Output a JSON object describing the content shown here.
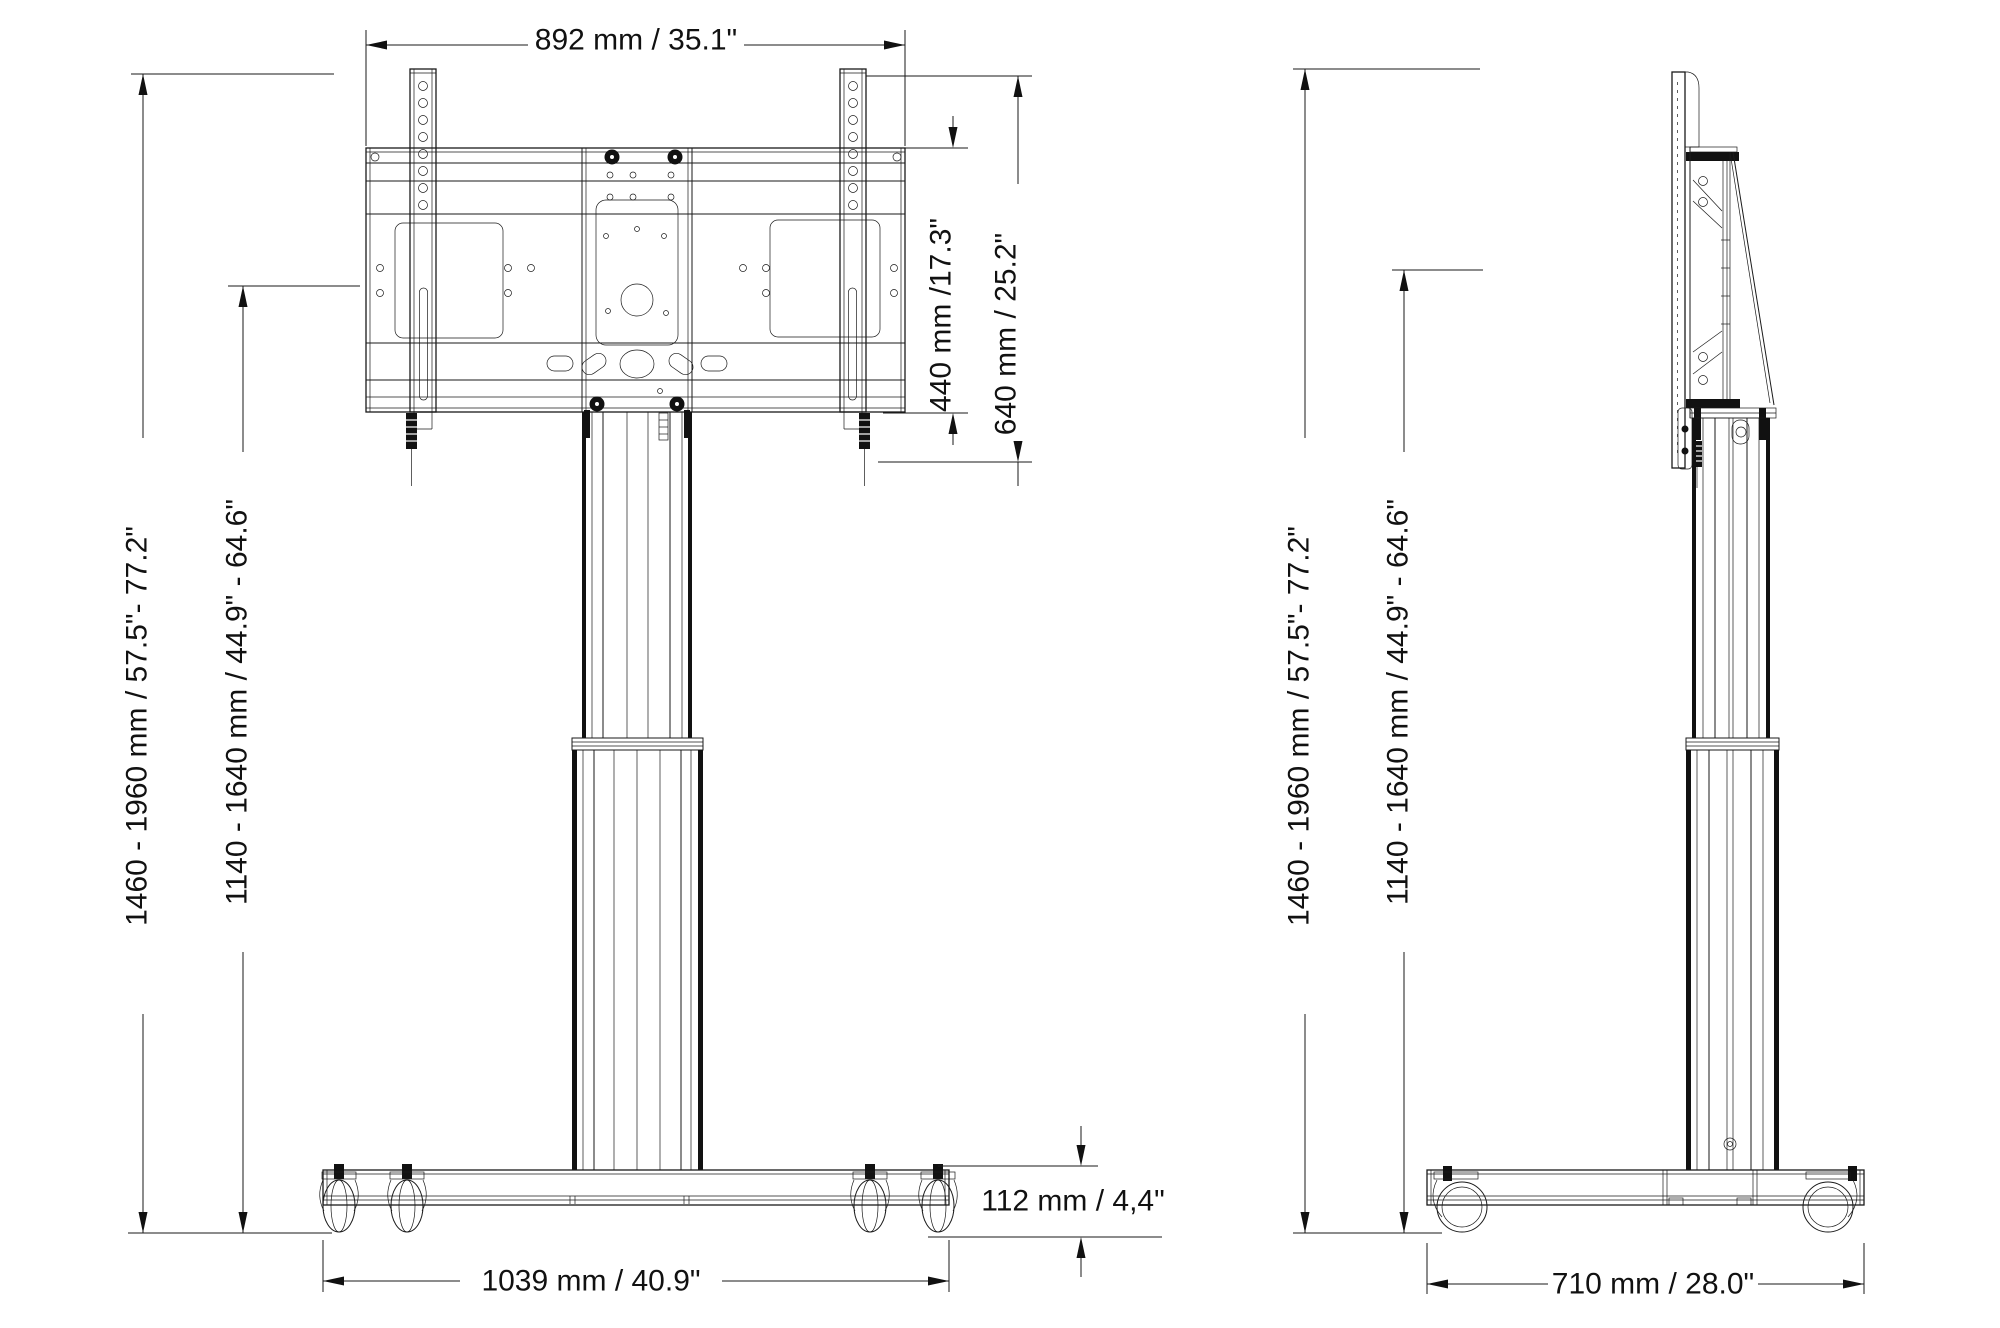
{
  "drawing": {
    "background": "#ffffff",
    "line_color": "#1a1a1a",
    "description": "Two-view technical dimension drawing of a height-adjustable TV trolley stand with casters",
    "views": {
      "front": {
        "name": "front-view",
        "dims": {
          "width": "892 mm / 35.1\"",
          "vesa_height": "440 mm /17.3\"",
          "mount_height": "640 mm / 25.2\"",
          "total_height": "1460 - 1960 mm / 57.5\"- 77.2\"",
          "screen_center_height": "1140 - 1640 mm / 44.9\" - 64.6\"",
          "base_height": "112 mm / 4,4\"",
          "base_width": "1039 mm / 40.9\""
        }
      },
      "side": {
        "name": "side-view",
        "dims": {
          "total_height": "1460 - 1960 mm / 57.5\"- 77.2\"",
          "screen_center_height": "1140 - 1640 mm / 44.9\" - 64.6\"",
          "base_depth": "710 mm / 28.0\""
        }
      }
    }
  }
}
